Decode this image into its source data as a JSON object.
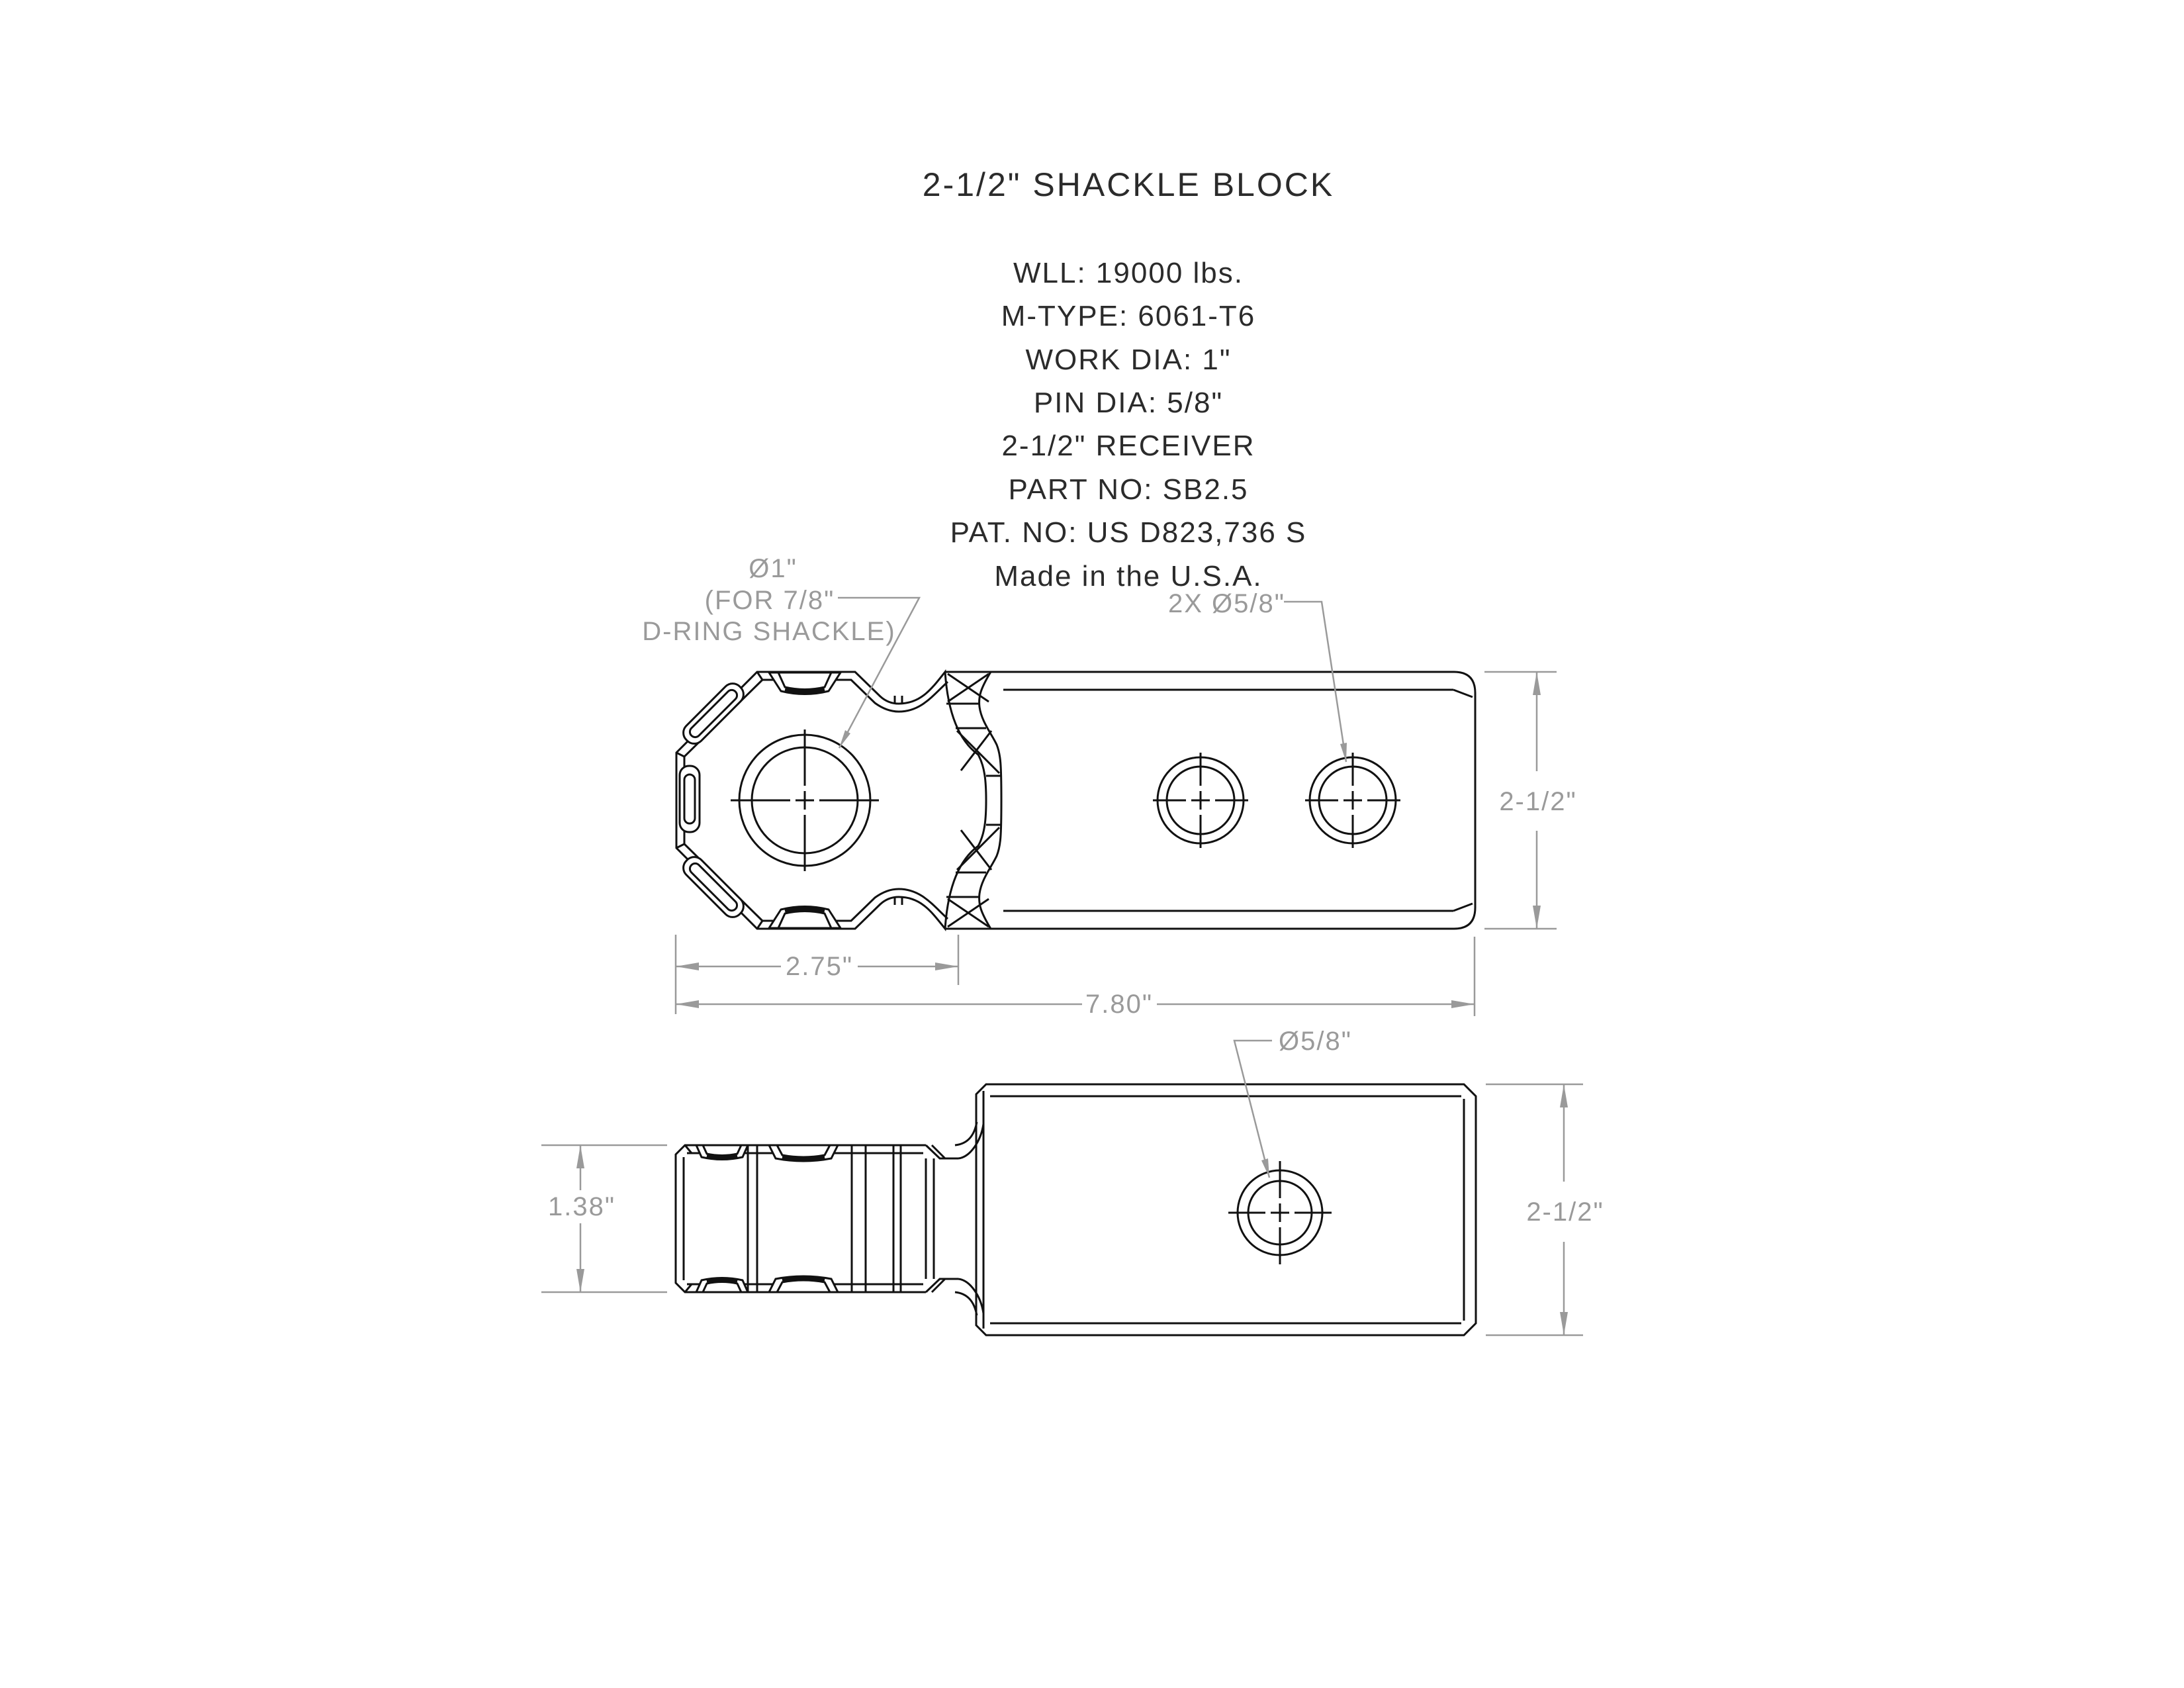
{
  "header": {
    "title": "2-1/2\" SHACKLE BLOCK"
  },
  "specs": {
    "lines": [
      "WLL: 19000 lbs.",
      "M-TYPE: 6061-T6",
      "WORK DIA: 1\"",
      "PIN DIA: 5/8\"",
      "2-1/2\" RECEIVER",
      "PART NO: SB2.5",
      "PAT. NO: US D823,736 S",
      "Made in the U.S.A."
    ]
  },
  "top_view": {
    "label_large_hole": [
      "Ø1\"",
      "(FOR 7/8\"",
      "D-RING SHACKLE)"
    ],
    "label_small_holes": "2X Ø5/8\"",
    "dim_height": "2-1/2\"",
    "dim_head_width": "2.75\"",
    "dim_overall_length": "7.80\""
  },
  "side_view": {
    "label_hole": "Ø5/8\"",
    "dim_shank_height": "1.38\"",
    "dim_height": "2-1/2\""
  },
  "colors": {
    "outline": "#111111",
    "dimension": "#9a9a9a",
    "text_dark": "#2b2b2b"
  }
}
